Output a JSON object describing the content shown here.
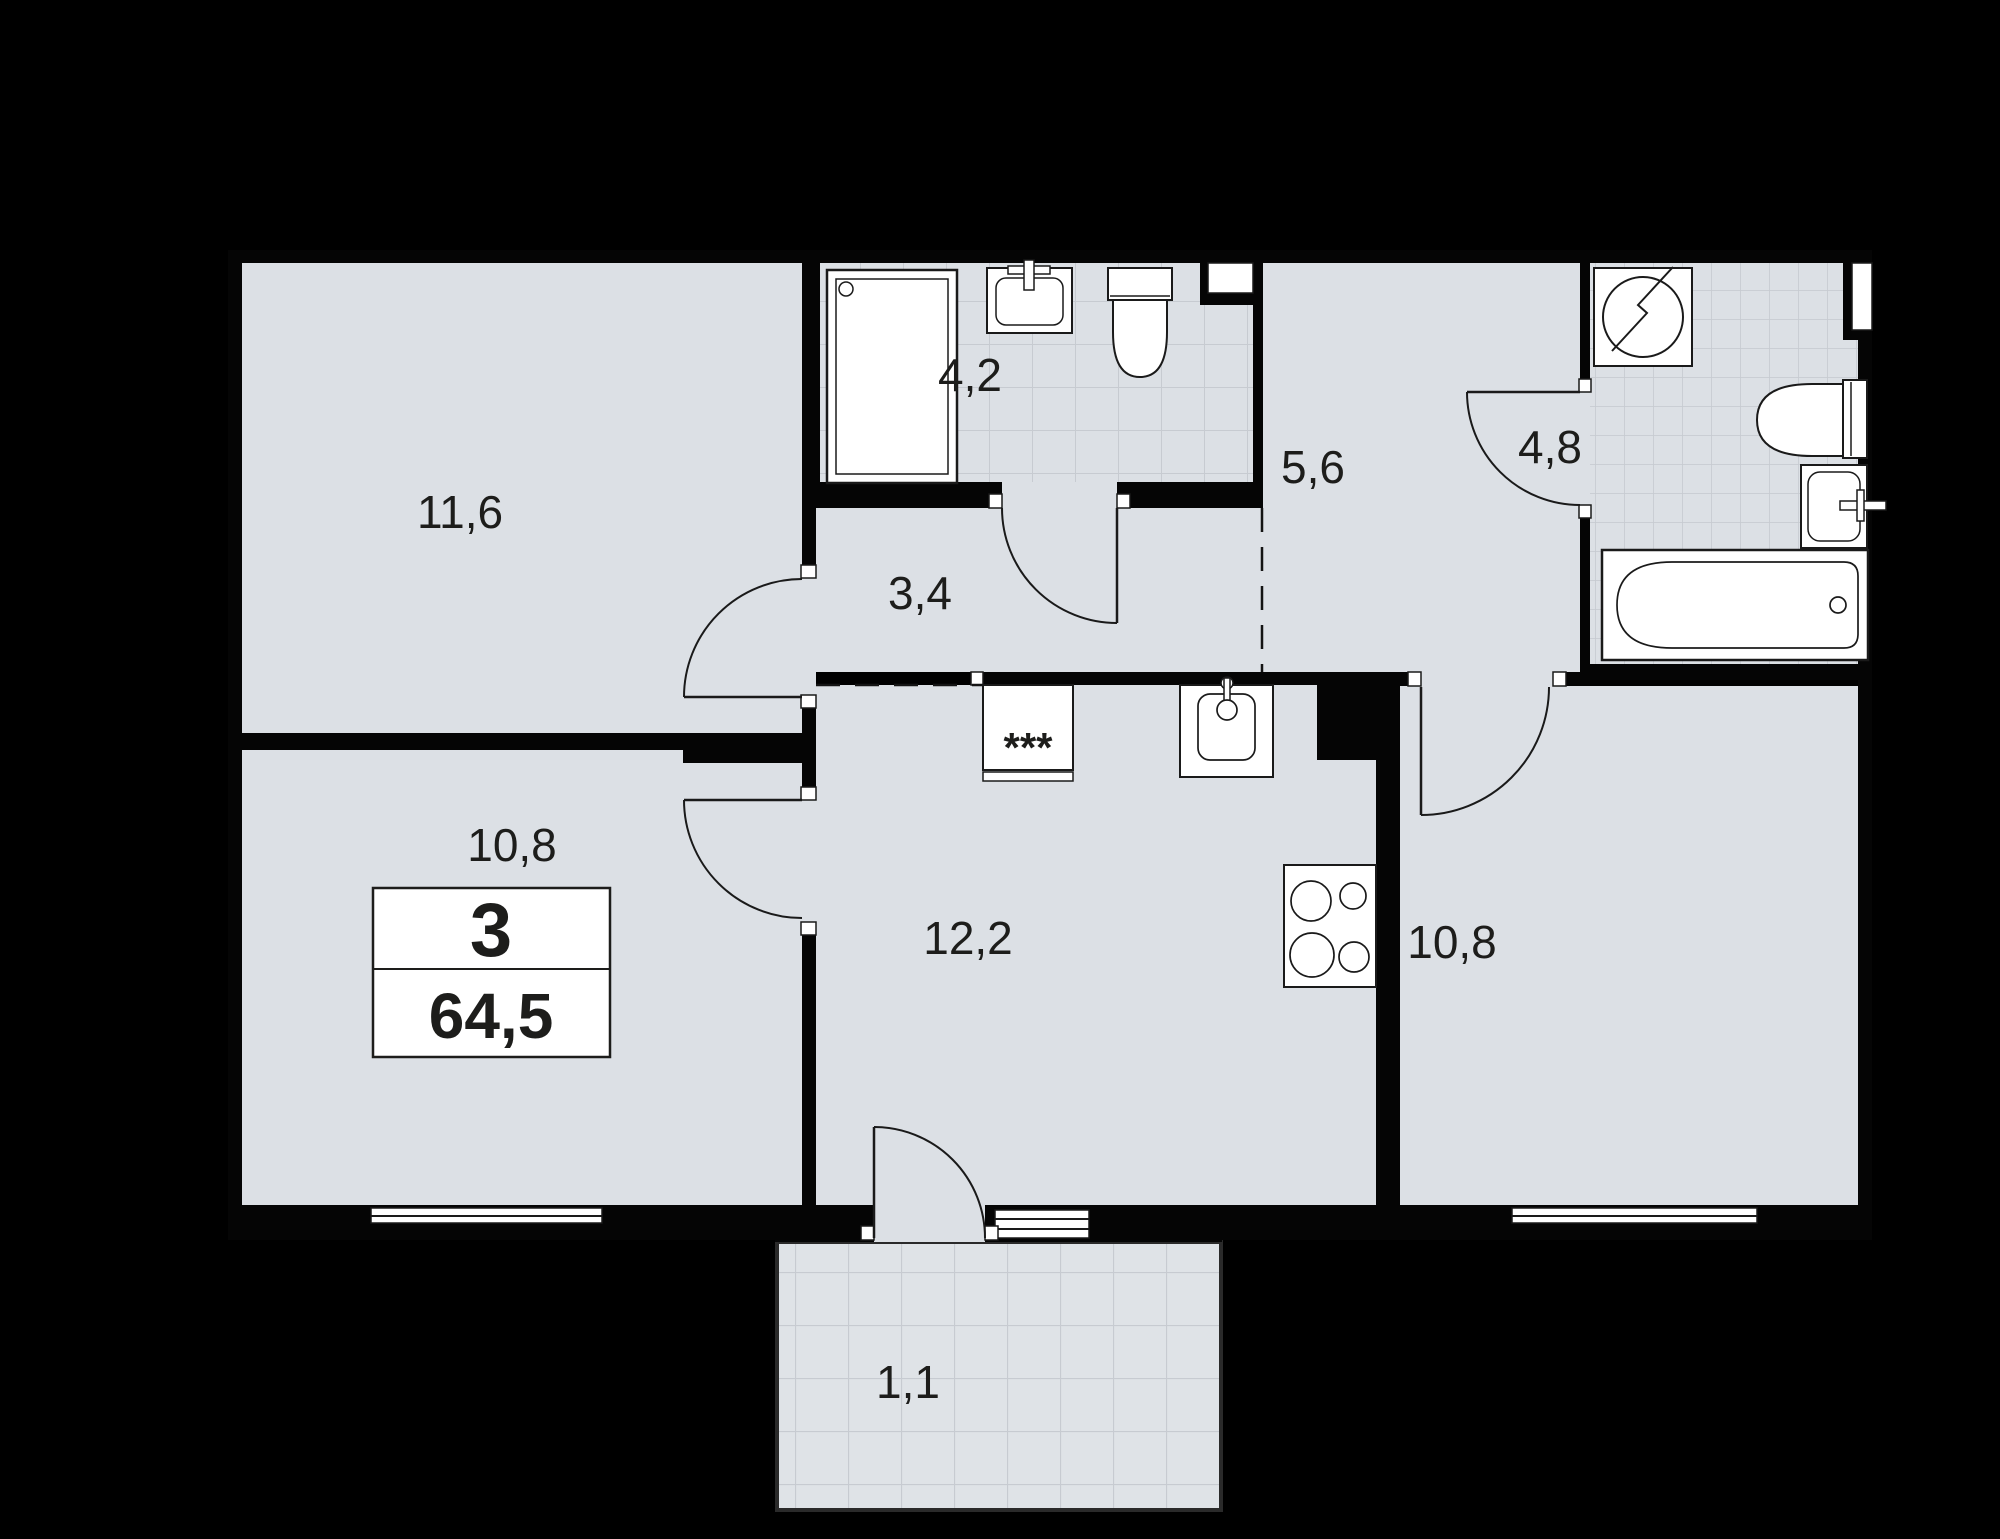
{
  "plan": {
    "type": "apartment-floor-plan",
    "info_box": {
      "rooms_count": "3",
      "total_area": "64,5"
    },
    "rooms": {
      "living": {
        "area": "11,6"
      },
      "bathroom_small": {
        "area": "4,2"
      },
      "hallway": {
        "area": "3,4"
      },
      "corridor": {
        "area": "5,6"
      },
      "bathroom_large": {
        "area": "4,8"
      },
      "bedroom_left": {
        "area": "10,8"
      },
      "kitchen": {
        "area": "12,2"
      },
      "bedroom_right": {
        "area": "10,8"
      },
      "balcony": {
        "area": "1,1"
      }
    },
    "fixtures": {
      "fridge_symbol": "***"
    },
    "colors": {
      "background": "#000000",
      "floor": "#dce0e5",
      "tile_line": "#c7cbd1",
      "wall": "#050505",
      "fixture_fill": "#ffffff",
      "fixture_stroke": "#1a1a1a",
      "text": "#1d1d1b"
    }
  }
}
